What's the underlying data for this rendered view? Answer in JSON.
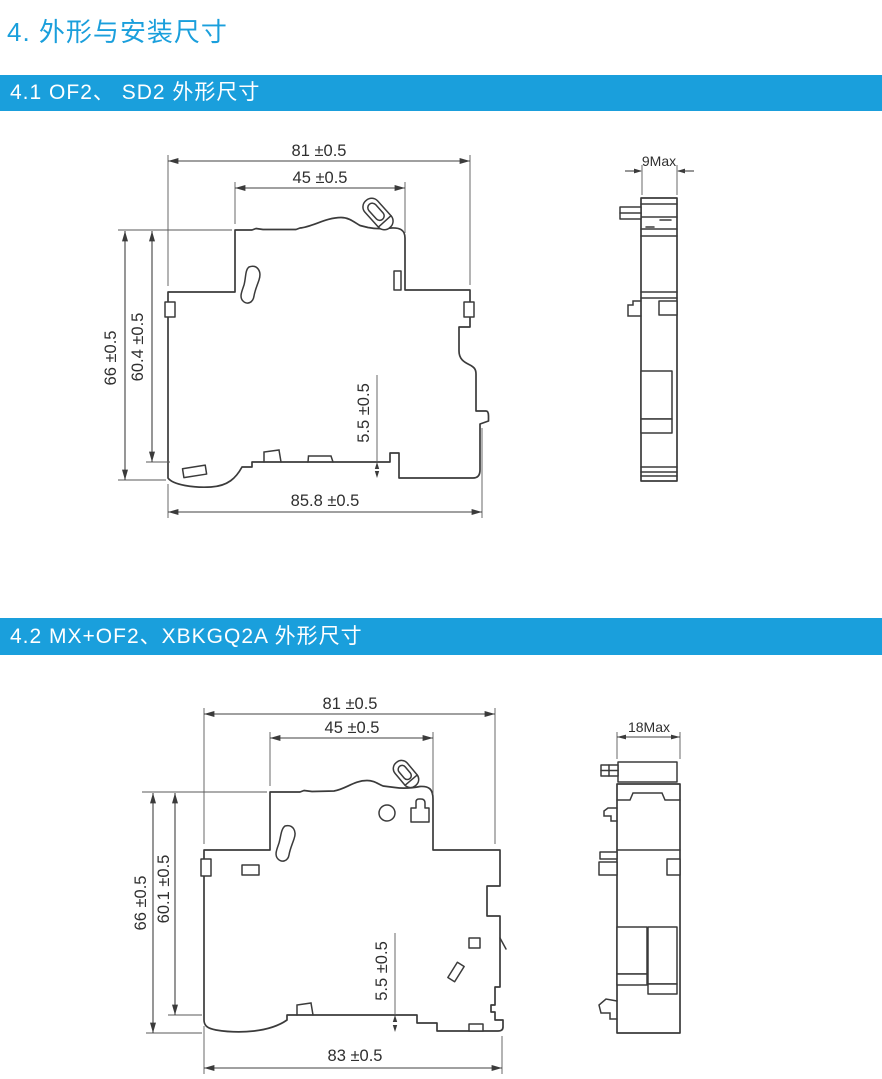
{
  "page": {
    "title": "4. 外形与安装尺寸"
  },
  "colors": {
    "accent": "#1A9FDC",
    "banner_text": "#FFFFFF",
    "drawing_line": "#3B3B3B",
    "dim_text": "#2F2F2F"
  },
  "sections": [
    {
      "heading": "4.1  OF2、 SD2 外形尺寸",
      "front": {
        "dim_width_top": "81 ±0.5",
        "dim_width_inner": "45 ±0.5",
        "dim_height_overall": "66 ±0.5",
        "dim_height_body": "60.4 ±0.5",
        "dim_foot_height": "5.5 ±0.5",
        "dim_width_bottom": "85.8 ±0.5"
      },
      "side": {
        "dim_depth": "9Max"
      }
    },
    {
      "heading": "4.2  MX+OF2、XBKGQ2A 外形尺寸",
      "front": {
        "dim_width_top": "81 ±0.5",
        "dim_width_inner": "45 ±0.5",
        "dim_height_overall": "66 ±0.5",
        "dim_height_body": "60.1 ±0.5",
        "dim_foot_height": "5.5 ±0.5",
        "dim_width_bottom": "83 ±0.5"
      },
      "side": {
        "dim_depth": "18Max"
      }
    }
  ]
}
